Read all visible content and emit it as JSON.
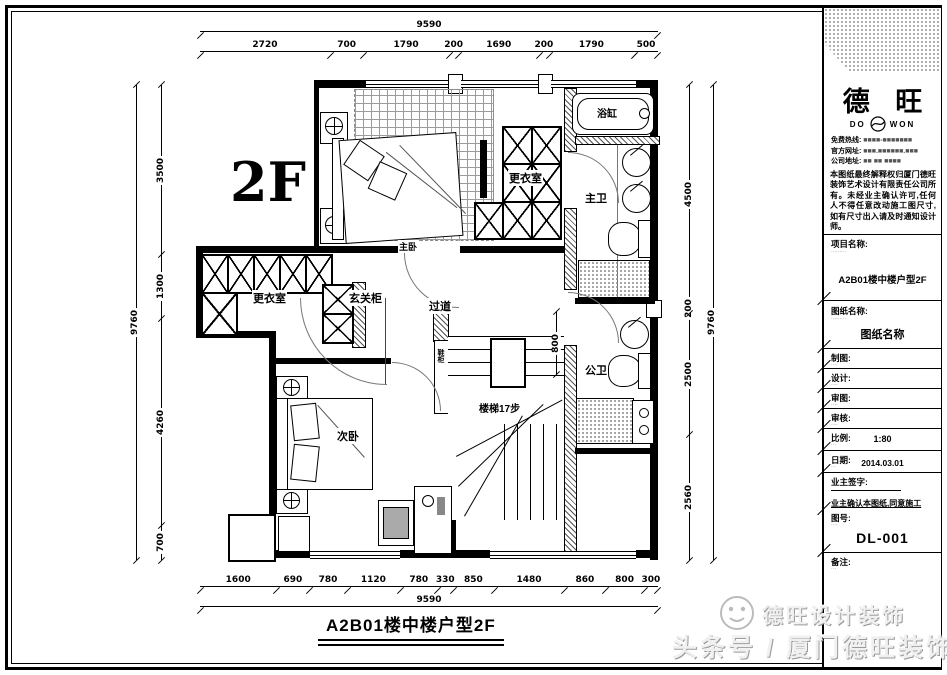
{
  "drawing": {
    "floor_label": "2F",
    "plan_title": "A2B01楼中楼户型2F",
    "rooms": {
      "master_bedroom": "主卧",
      "dressing_right": "更衣室",
      "master_bath": "主卫",
      "bathtub": "浴缸",
      "dressing_left": "更衣室",
      "entry_cabinet": "玄关柜",
      "hallway": "过道",
      "public_bath": "公卫",
      "second_bedroom": "次卧",
      "stairs": "楼梯17步",
      "shoe_cabinet": "鞋柜"
    },
    "dims": {
      "top_total": [
        "9590"
      ],
      "top_segments": [
        2720,
        700,
        1790,
        200,
        1690,
        200,
        1790,
        500
      ],
      "left_total": [
        "9760"
      ],
      "left_segments": [
        3500,
        1300,
        4260,
        700
      ],
      "right_total": [
        "9760"
      ],
      "right_segments": [
        4500,
        200,
        2500,
        2560
      ],
      "bottom_total": [
        "9590"
      ],
      "bottom_segments": [
        1600,
        690,
        780,
        1120,
        780,
        330,
        850,
        1480,
        860,
        800,
        300
      ],
      "interior_segments": [
        800
      ]
    }
  },
  "titleblock": {
    "brand": {
      "cn": "德 旺",
      "en_left": "DO",
      "en_right": "WON"
    },
    "contact": [
      {
        "label": "免费热线:",
        "value": "■■■■-■■■■■■■"
      },
      {
        "label": "官方网址:",
        "value": "■■■.■■■■■■.■■■"
      },
      {
        "label": "公司地址:",
        "value": "■■ ■■ ■■■■"
      }
    ],
    "copyright": "本图纸最终解释权归厦门德旺装饰艺术设计有限责任公司所有。未经业主确认许可,任何人不得任意改动施工图尺寸,如有尺寸出入请及时通知设计师。",
    "project_label": "项目名称:",
    "project_sub": "·········",
    "project_value": "A2B01楼中楼户型2F",
    "sheet_label": "图纸名称:",
    "sheet_sub": "·········",
    "sheet_value": "图纸名称",
    "rows": [
      {
        "label": "制图:",
        "sub": "····"
      },
      {
        "label": "设计:",
        "sub": "····"
      },
      {
        "label": "审图:",
        "sub": "····"
      },
      {
        "label": "审核:",
        "sub": "····"
      }
    ],
    "scale_label": "比例:",
    "scale_sub": "···",
    "scale_value": "1:80",
    "date_label": "日期:",
    "date_sub": "···",
    "date_value": "2014.03.01",
    "sign_label": "业主签字:",
    "confirm_note": "业主确认本图纸,同意施工",
    "no_label": "图号:",
    "no_sub": "····",
    "no_value": "DL-001",
    "remark_label": "备注:",
    "remark_sub": "···"
  },
  "watermark": {
    "line1": "德旺设计装饰",
    "line2": "头条号 / 厦门德旺装饰"
  }
}
